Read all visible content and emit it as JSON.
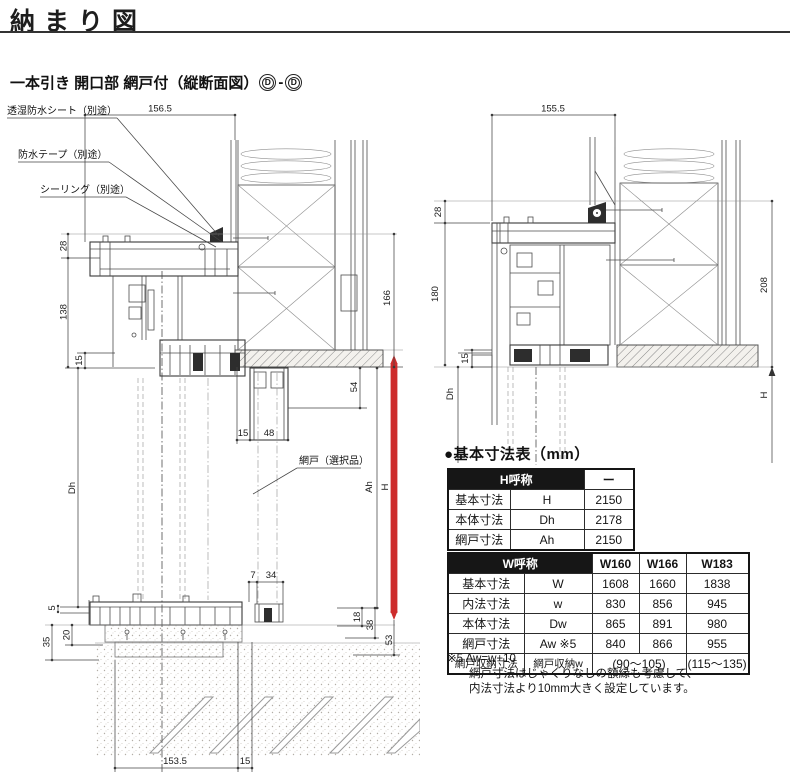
{
  "page": {
    "title": "納まり図",
    "subtitle": "一本引き 開口部 網戸付（縦断面図）",
    "section_mark_left": "D",
    "section_sep": "-",
    "section_mark_right": "D",
    "accent_red": "#cd2c2c",
    "table_header_bg": "#161616"
  },
  "left_drawing": {
    "callout_sheet": "透湿防水シート（別途）",
    "callout_tape": "防水テープ（別途）",
    "callout_sealing": "シーリング（別途）",
    "callout_screen": "網戸（選択品）",
    "dims": {
      "top_width": "156.5",
      "head_28": "28",
      "head_138": "138",
      "left_15": "15",
      "dh": "Dh",
      "sill_5": "5",
      "sill_35": "35",
      "sill_20": "20",
      "right_166": "166",
      "ah": "Ah",
      "h": "H",
      "screen_54": "54",
      "screen_15": "15",
      "screen_48": "48",
      "rail_7": "7",
      "rail_34": "34",
      "base_18": "18",
      "base_38": "38",
      "base_53": "53",
      "bottom_153_5": "153.5",
      "bottom_15": "15"
    }
  },
  "right_drawing": {
    "dims": {
      "top_width": "155.5",
      "head_28": "28",
      "head_180": "180",
      "left_15": "15",
      "dh": "Dh",
      "right_208": "208",
      "h": "H"
    }
  },
  "spec": {
    "heading": "●基本寸法表（mm）",
    "h_table": {
      "header_label": "H呼称",
      "header_value": "ー",
      "rows": [
        {
          "name": "基本寸法",
          "symbol": "H",
          "value": "2150"
        },
        {
          "name": "本体寸法",
          "symbol": "Dh",
          "value": "2178"
        },
        {
          "name": "網戸寸法",
          "symbol": "Ah",
          "value": "2150"
        }
      ]
    },
    "w_table": {
      "header_label": "W呼称",
      "cols": [
        "W160",
        "W166",
        "W183"
      ],
      "rows": [
        {
          "name": "基本寸法",
          "symbol": "W",
          "v1": "1608",
          "v2": "1660",
          "v3": "1838"
        },
        {
          "name": "内法寸法",
          "symbol": "w",
          "v1": "830",
          "v2": "856",
          "v3": "945"
        },
        {
          "name": "本体寸法",
          "symbol": "Dw",
          "v1": "865",
          "v2": "891",
          "v3": "980"
        },
        {
          "name": "網戸寸法",
          "symbol": "Aw ※5",
          "v1": "840",
          "v2": "866",
          "v3": "955"
        }
      ],
      "storage_row": {
        "name": "網戸収納寸法",
        "symbol": "網戸収納w",
        "v12": "(90〜105)",
        "v3": "(115〜135)"
      }
    },
    "footnote_1": "※5 Aw=w+10",
    "footnote_2": "網戸寸法はじゃくりなしの額縁も考慮して、",
    "footnote_3": "内法寸法より10mm大きく設定しています。"
  }
}
